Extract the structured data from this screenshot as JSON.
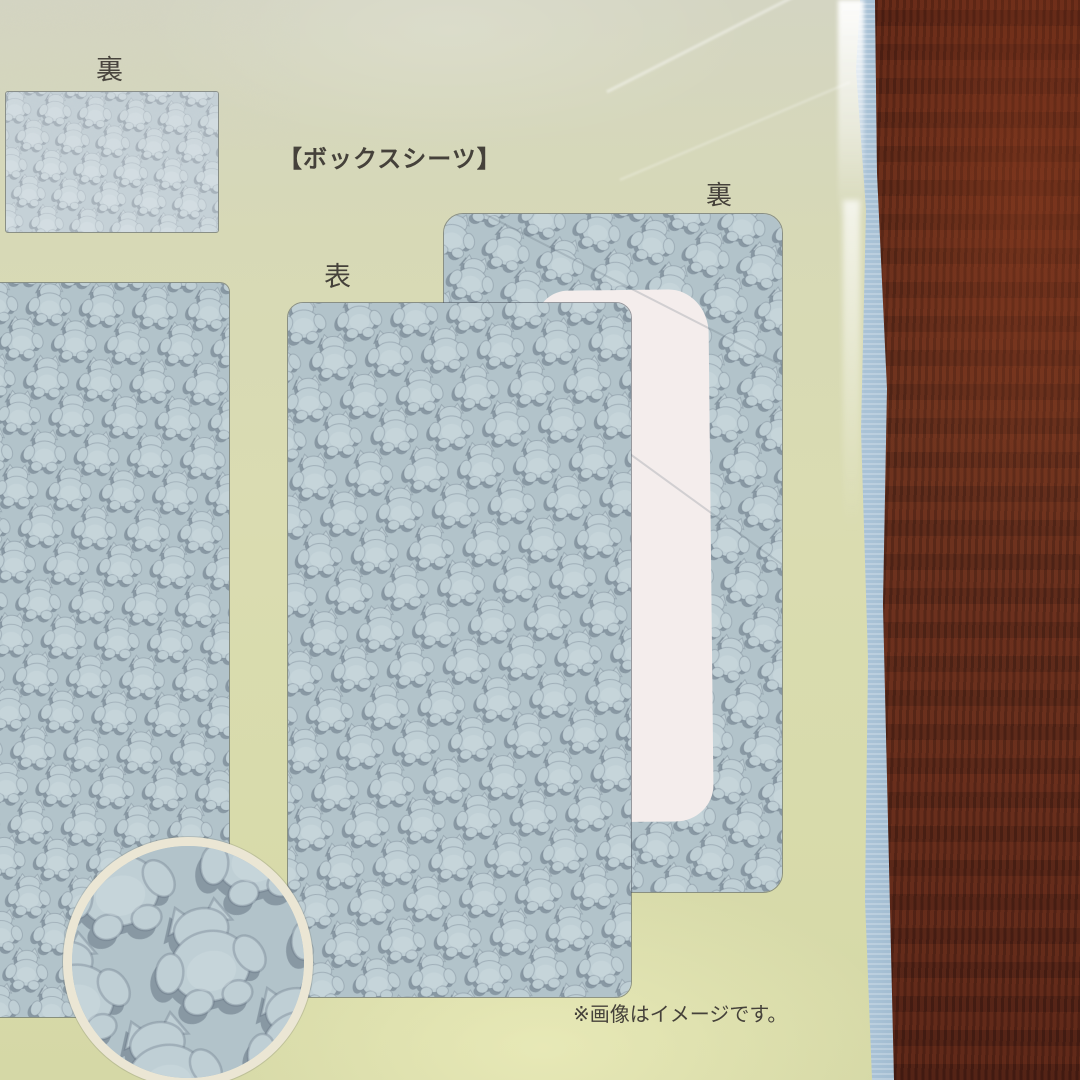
{
  "labels": {
    "back_top_left": "裏",
    "title": "【ボックスシーツ】",
    "front": "表",
    "back_right": "裏",
    "disclaimer": "※画像はイメージです。"
  },
  "colors": {
    "paper_green": "#d8dbab",
    "pattern_bg": "#b2c3ca",
    "pattern_motif": "#bfcfd5",
    "pattern_shadow": "#5a6878",
    "cutout_white": "#f4edec",
    "circle_ring": "#ebe6d4",
    "wood_brown": "#5e2a1c",
    "fabric_blue": "#a9c2d6",
    "text": "#45413a"
  }
}
